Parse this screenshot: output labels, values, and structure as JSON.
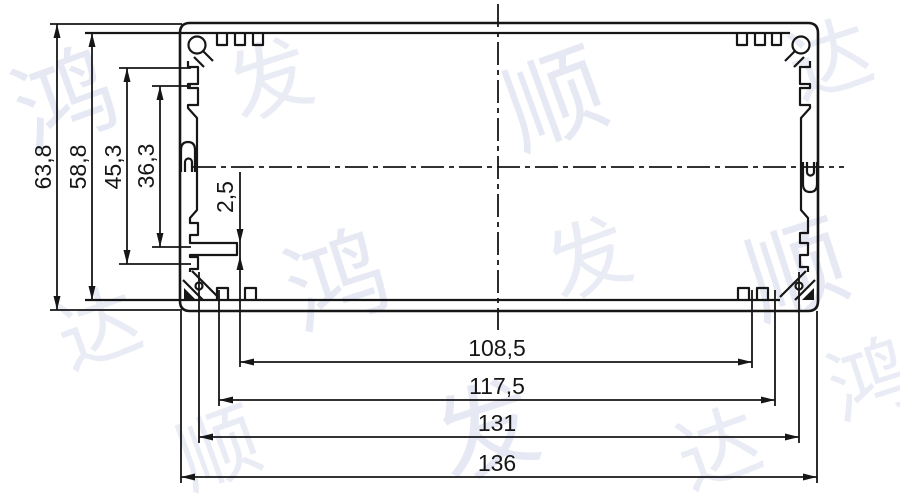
{
  "document": {
    "type": "CAD cross-section drawing",
    "subject": "aluminum extrusion enclosure profile"
  },
  "dimensions": {
    "vertical": {
      "overall_height": "63,8",
      "inner_height": "58,8",
      "groove_span_outer": "45,3",
      "groove_span_inner": "36,3",
      "rib_thickness": "2,5"
    },
    "horizontal": {
      "slot_width": "108,5",
      "step_width": "117,5",
      "inner_width": "131",
      "overall_width": "136"
    }
  },
  "watermark": {
    "text": "鸿发顺达",
    "chars": [
      "鸿",
      "发",
      "顺",
      "达"
    ],
    "color": "#e4e7f2"
  },
  "colors": {
    "line": "#161616",
    "background": "#ffffff"
  }
}
